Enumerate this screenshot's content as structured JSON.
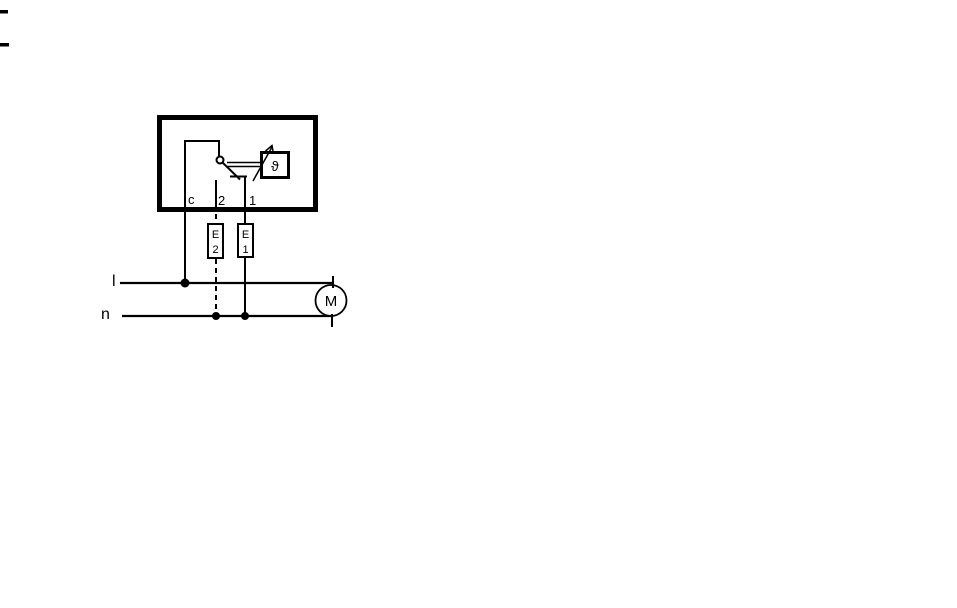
{
  "diagram": {
    "kind": "thermostat-motor-wiring-schematic",
    "colors": {
      "ink": "#000000",
      "background": "#ffffff"
    },
    "device": {
      "terminals": {
        "c": "c",
        "t2": "2",
        "t1": "1"
      },
      "thermostat_symbol": "ϑ"
    },
    "elements": {
      "e2": {
        "line1": "E",
        "line2": "2"
      },
      "e1": {
        "line1": "E",
        "line2": "1"
      }
    },
    "supply": {
      "line": "l",
      "neutral": "n"
    },
    "motor": {
      "label": "M"
    }
  }
}
